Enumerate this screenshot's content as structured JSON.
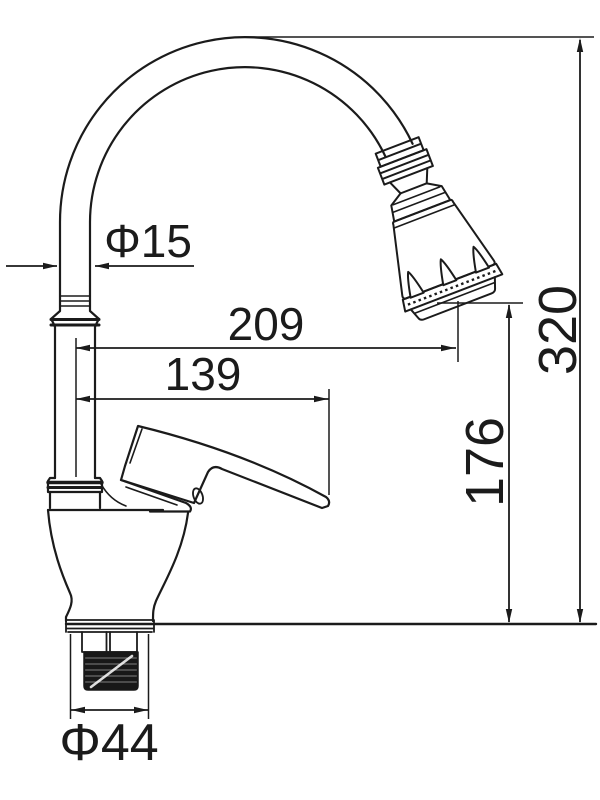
{
  "figure": {
    "type": "dimensioned technical line drawing",
    "subject": "kitchen faucet with flexible gooseneck spout, spray head, lever handle and threaded mounting shank",
    "line_color": "#1b1b1b",
    "background_color": "#ffffff"
  },
  "dimensions": {
    "pipe_diameter": {
      "label": "Φ15",
      "value": 15,
      "kind": "diameter",
      "orientation": "horizontal"
    },
    "spout_reach": {
      "label": "209",
      "value": 209,
      "kind": "length",
      "orientation": "horizontal"
    },
    "handle_reach": {
      "label": "139",
      "value": 139,
      "kind": "length",
      "orientation": "horizontal"
    },
    "outlet_height": {
      "label": "176",
      "value": 176,
      "kind": "height",
      "orientation": "vertical"
    },
    "overall_height": {
      "label": "320",
      "value": 320,
      "kind": "height",
      "orientation": "vertical"
    },
    "base_diameter": {
      "label": "Φ44",
      "value": 44,
      "kind": "diameter",
      "orientation": "horizontal"
    }
  }
}
